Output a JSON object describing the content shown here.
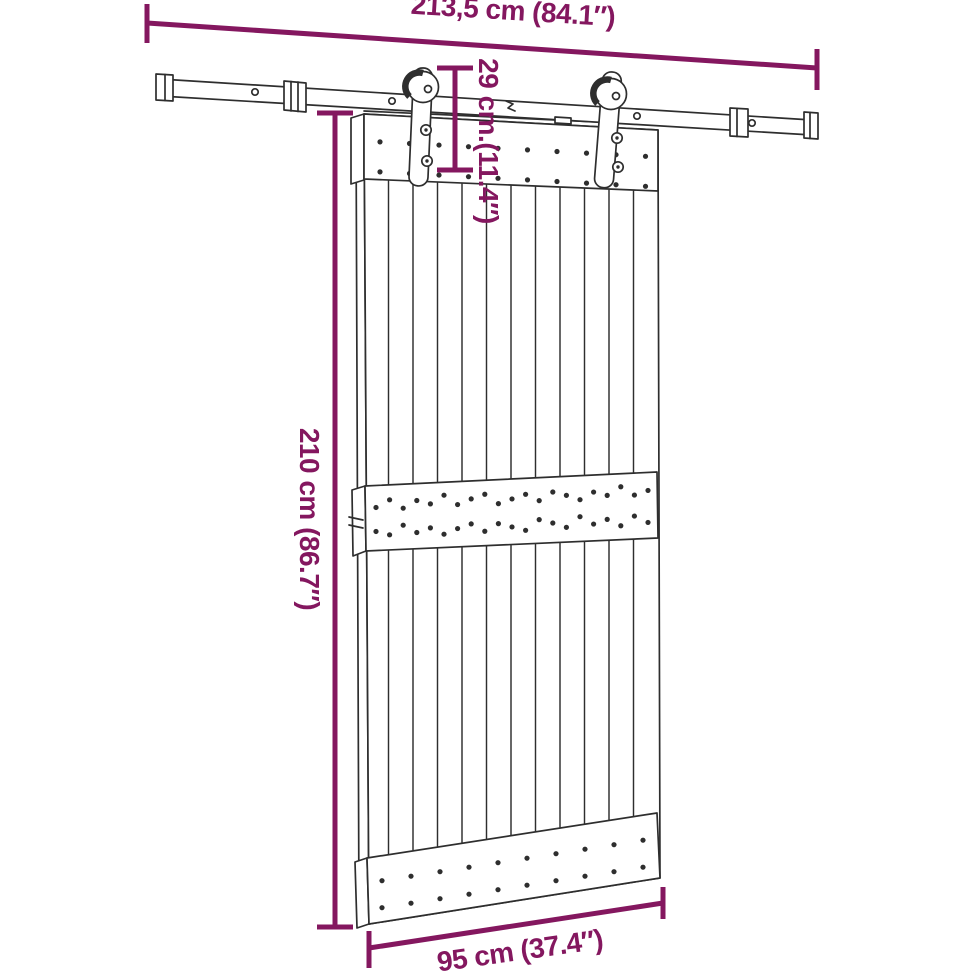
{
  "labels": {
    "rail_width": "213,5 cm (84.1″)",
    "top_offset": "29 cm.(11.4″)",
    "door_height": "210 cm (86.7″)",
    "door_width": "95 cm (37.4″)"
  },
  "colors": {
    "dimension": "#84175f",
    "line_art": "#2e2e2e",
    "background": "#ffffff"
  }
}
